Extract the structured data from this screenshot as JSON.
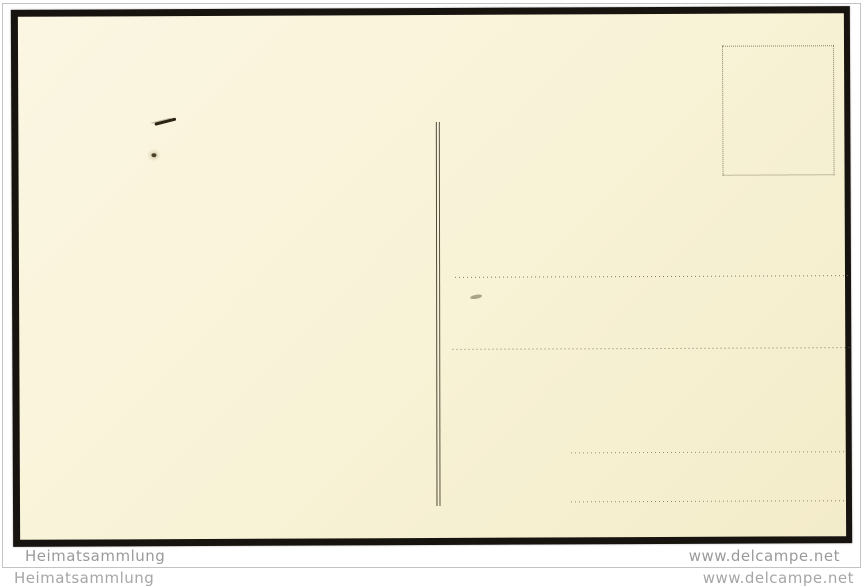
{
  "watermarks": {
    "inner_left": "Heimatsammlung",
    "inner_right": "www.delcampe.net",
    "outer_left": "Heimatsammlung",
    "outer_right": "www.delcampe.net"
  },
  "postcard": {
    "elements": [
      "stamp-box-dotted-rectangle",
      "message-address-divider-double-line",
      "address-dotted-line-1",
      "address-dotted-line-2",
      "address-dotted-line-3",
      "address-dotted-line-4"
    ]
  },
  "colors": {
    "card_cream": "#f8f2d6",
    "photo_frame_black": "#17130e",
    "listing_border_gray": "#c3c3c3",
    "watermark_gray": "#a0a0a0",
    "print_dot_brown": "#6e6350",
    "page_background": "#ffffff"
  }
}
